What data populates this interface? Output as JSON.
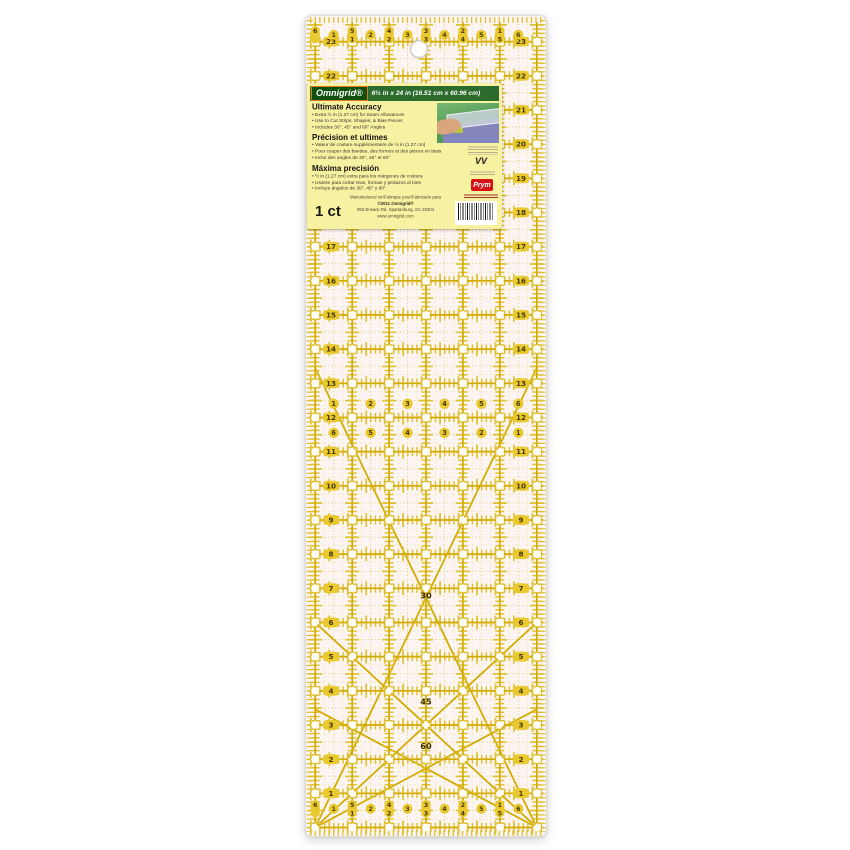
{
  "label": {
    "brand": "Omnigrid®",
    "size": "6½ in x 24 in (16.51 cm x 60.96 cm)",
    "sections": [
      {
        "heading": "Ultimate Accuracy",
        "bullets": [
          "Extra ½ in (1.27 cm) for Seam Allowances",
          "Use to Cut Strips, Shapes, & Bias Pieces",
          "Includes 30°, 45° and 60° Angles"
        ]
      },
      {
        "heading": "Précision et ultimes",
        "bullets": [
          "Valeur de couture supplémentaire de ½ in (1.27 cm)",
          "Pour couper des bandes, des formes et des pièces en biais",
          "Inclut des angles de 30°, 45° et 60°"
        ]
      },
      {
        "heading": "Máxima precisión",
        "bullets": [
          "½ in (1.27 cm) extra para los márgenes de costura",
          "Usarse para cortar tiras, formas y pedazos al bies",
          "Incluye ángulos de 30°, 45° y 60°"
        ]
      }
    ],
    "count": "1 ct",
    "footer_lines": [
      "Manufactured for/Fabriqué pour/Fabricado para",
      "©2011 Omnigrid®",
      "950 Brisack Rd, Spartanburg, SC  29304",
      "www.omnigrid.com"
    ],
    "vv_mark": "VV",
    "prym_logo": "Prym"
  },
  "ruler": {
    "description": "6.5 in x 24 in quilting ruler grid, 1 inch squares with 1/8 inch ticks",
    "colors": {
      "line": "#d3ab00",
      "tick": "#dfc233",
      "minor": "#e3c765",
      "minor_weak": "#efdf9f",
      "marker_fill": "#e9c92e",
      "marker_text": "#473a02",
      "angle_text": "#3a3000",
      "bg": "#fdf5f3"
    },
    "side_numbers": [
      23,
      22,
      21,
      20,
      19,
      18,
      17,
      16,
      15,
      14,
      13,
      12,
      11,
      10,
      9,
      8,
      7,
      6,
      5,
      4,
      3,
      2,
      1
    ],
    "edge_pills": [
      [
        "6",
        ""
      ],
      [
        "5",
        "1"
      ],
      [
        "4",
        "2"
      ],
      [
        "3",
        "3"
      ],
      [
        "2",
        "4"
      ],
      [
        "1",
        "5"
      ]
    ],
    "edge_circles": [
      "1",
      "2",
      "3",
      "4",
      "5",
      "6"
    ],
    "mid_rows": [
      {
        "y_in": 12.4,
        "values": [
          "1",
          "2",
          "3",
          "4",
          "5",
          "6"
        ]
      },
      {
        "y_in": 11.55,
        "values": [
          "6",
          "5",
          "4",
          "3",
          "2",
          "1"
        ]
      }
    ],
    "angle_labels": [
      {
        "text": "30",
        "x_in": 3.25,
        "y_in": 6.7
      },
      {
        "text": "45",
        "x_in": 3.25,
        "y_in": 3.6
      },
      {
        "text": "60",
        "x_in": 3.25,
        "y_in": 2.3
      }
    ],
    "diagonals": [
      {
        "angle": 45,
        "from": [
          0.25,
          0
        ],
        "to": [
          6.25,
          6.0
        ]
      },
      {
        "angle": 45,
        "from": [
          6.25,
          0
        ],
        "to": [
          0.25,
          6.0
        ]
      },
      {
        "angle": 30,
        "from": [
          0.25,
          0
        ],
        "to": [
          6.25,
          3.46
        ]
      },
      {
        "angle": 30,
        "from": [
          6.25,
          0
        ],
        "to": [
          0.25,
          3.46
        ]
      },
      {
        "angle": 60,
        "from": [
          0.25,
          0
        ],
        "to": [
          6.25,
          13.45
        ]
      },
      {
        "angle": 60,
        "from": [
          6.25,
          0
        ],
        "to": [
          0.25,
          13.45
        ]
      }
    ],
    "hole": {
      "x_in": 3.06,
      "y_in": 22.78
    }
  }
}
